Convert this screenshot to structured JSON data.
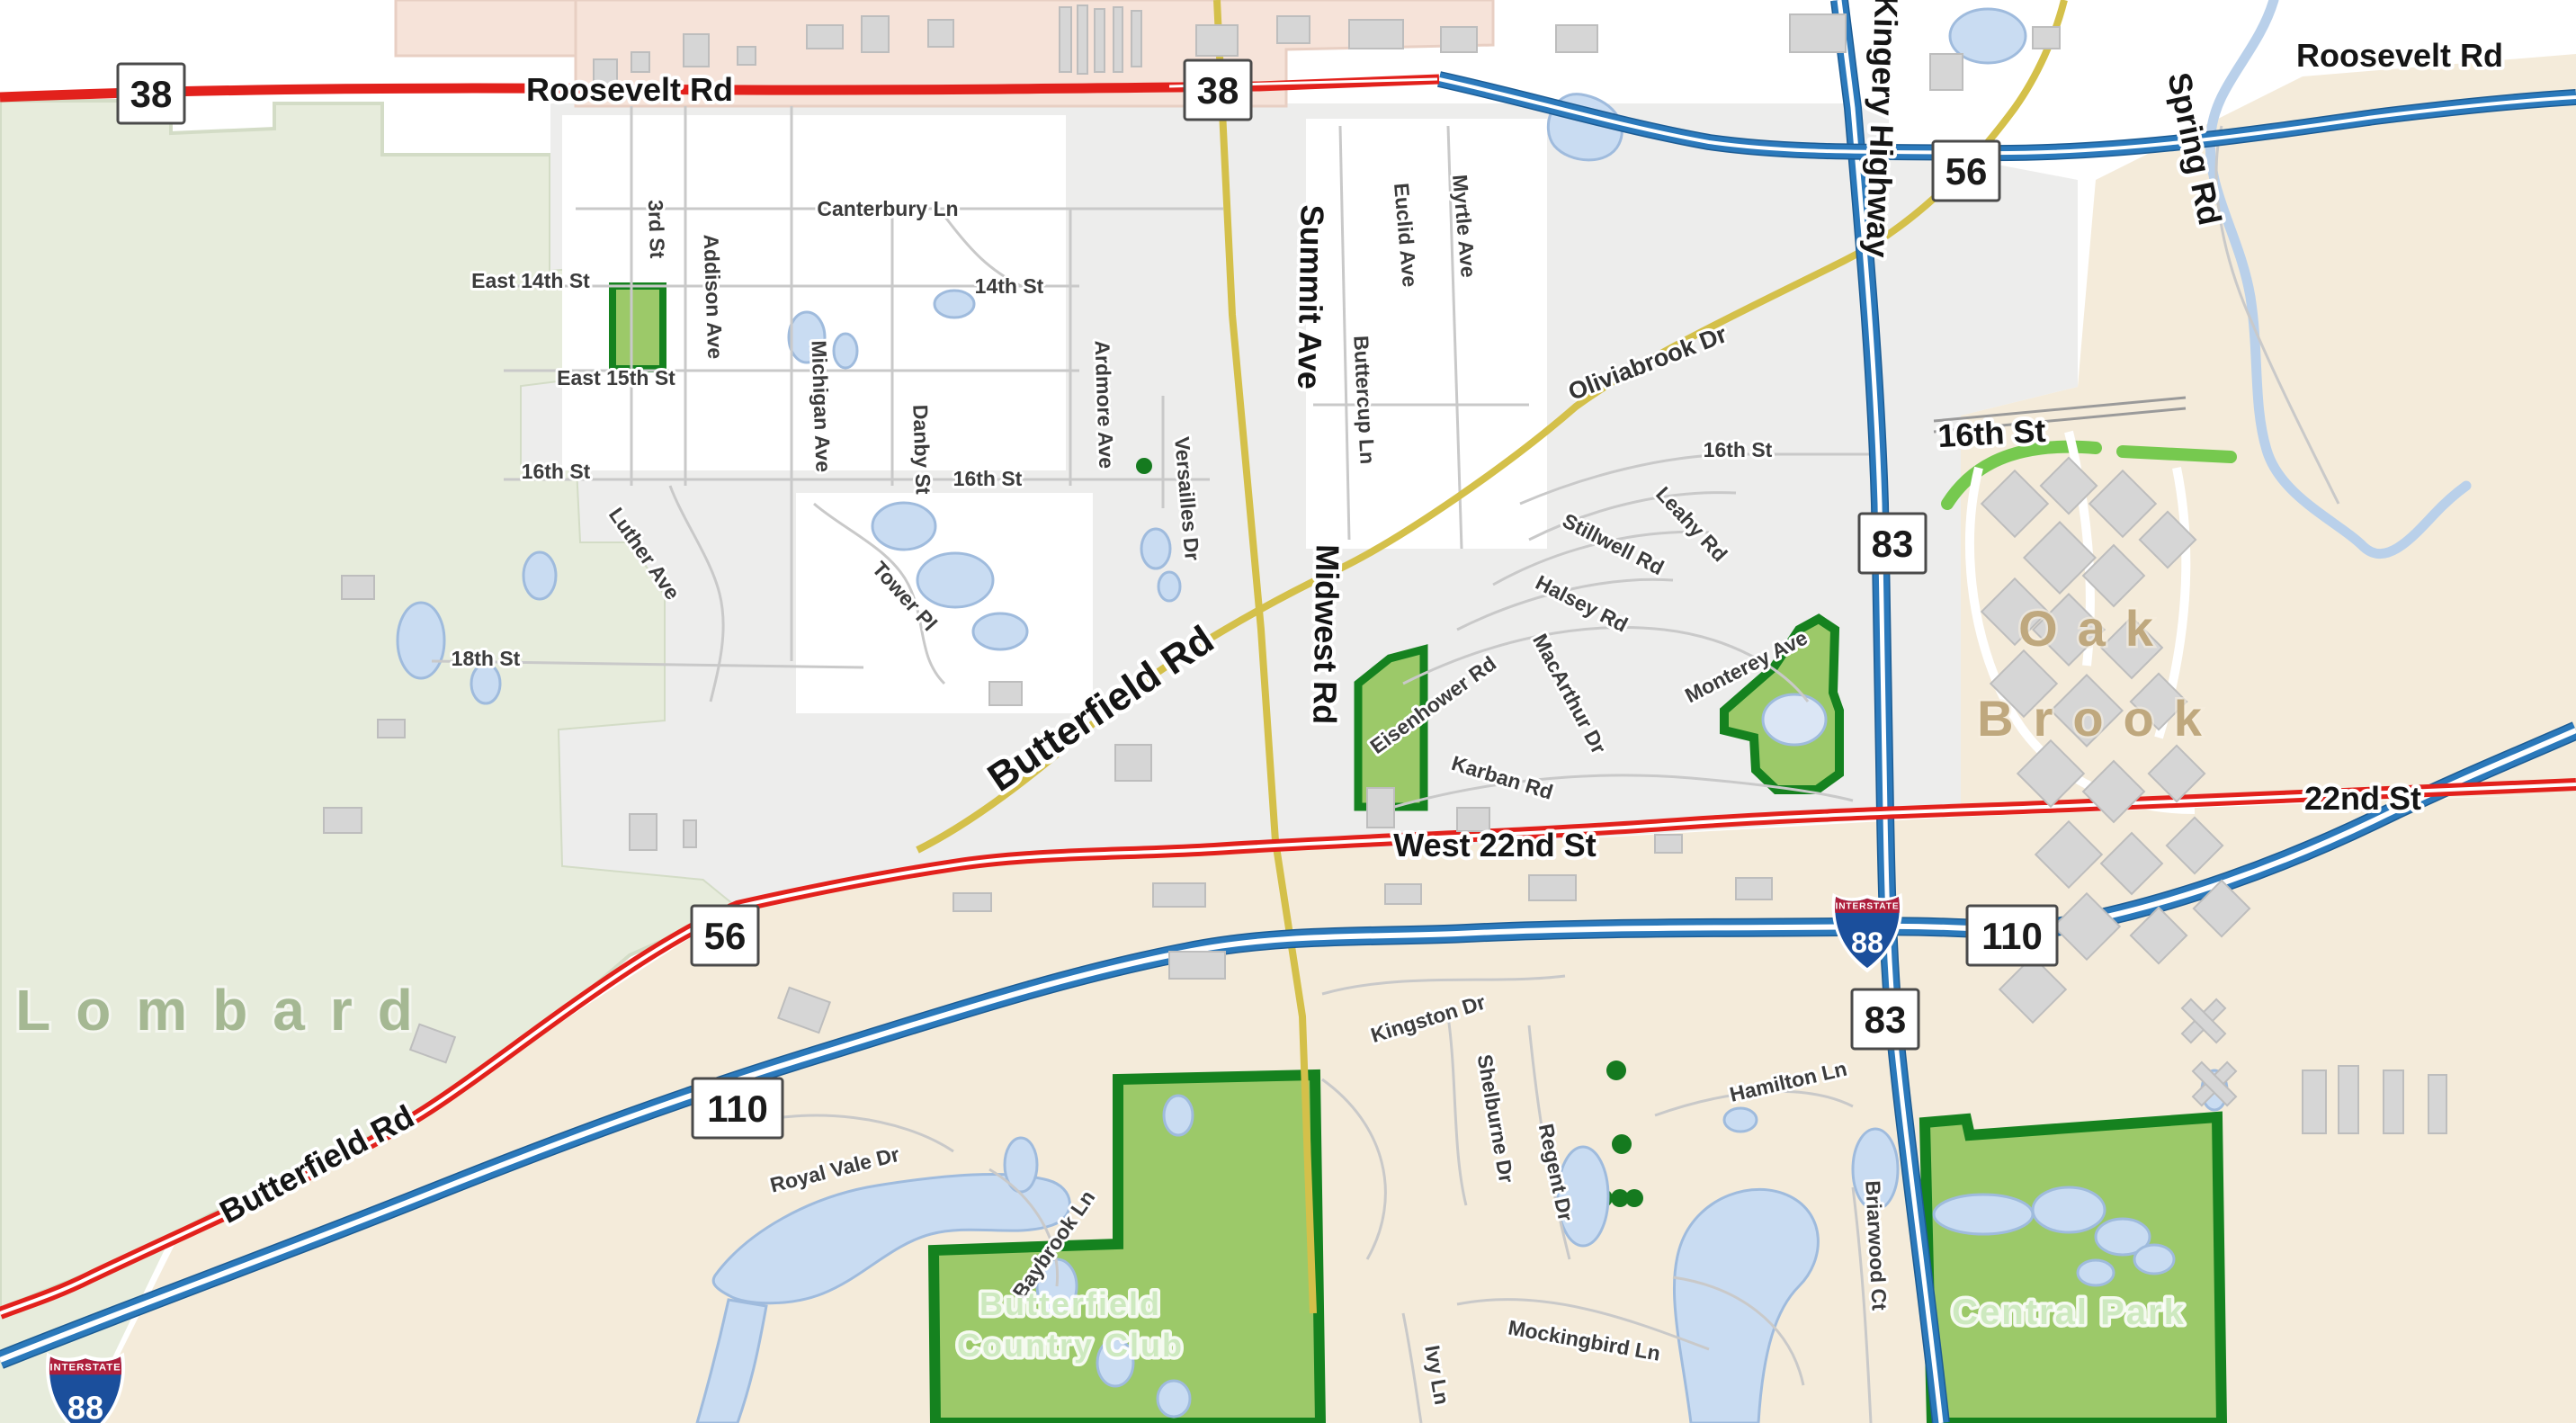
{
  "map": {
    "place_labels": {
      "lombard": "Lombard",
      "oak_brook_line1": "Oak",
      "oak_brook_line2": "Brook"
    },
    "area_labels": {
      "butterfield_cc_line1": "Butterfield",
      "butterfield_cc_line2": "Country Club",
      "central_park": "Central Park"
    },
    "major_roads": {
      "roosevelt_w": "Roosevelt Rd",
      "roosevelt_e": "Roosevelt Rd",
      "kingery": "Kingery Highway",
      "spring": "Spring Rd",
      "summit": "Summit Ave",
      "midwest": "Midwest Rd",
      "butterfield_center": "Butterfield Rd",
      "butterfield_sw": "Butterfield Rd",
      "west_22nd": "West 22nd St",
      "east_22nd": "22nd St",
      "sixteenth_bold": "16th St",
      "oliviabrook": "Oliviabrook Dr"
    },
    "streets": {
      "canterbury": "Canterbury Ln",
      "east_14th": "East 14th St",
      "third": "3rd St",
      "addison": "Addison Ave",
      "east_15th": "East 15th St",
      "fourteenth": "14th St",
      "michigan": "Michigan Ave",
      "danby": "Danby St",
      "ardmore": "Ardmore Ave",
      "sixteenth_w": "16th St",
      "sixteenth_mid": "16th St",
      "sixteenth_e": "16th St",
      "versailles": "Versailles Dr",
      "luther": "Luther Ave",
      "tower": "Tower Pl",
      "eighteenth": "18th St",
      "buttercup": "Buttercup Ln",
      "euclid": "Euclid Ave",
      "myrtle": "Myrtle Ave",
      "leahy": "Leahy Rd",
      "stillwell": "Stillwell Rd",
      "halsey": "Halsey Rd",
      "macarthur": "MacArthur Dr",
      "eisenhower": "Eisenhower Rd",
      "monterey": "Monterey Ave",
      "karban": "Karban Rd",
      "kingston": "Kingston Dr",
      "shelburne": "Shelburne Dr",
      "regent": "Regent Dr",
      "hamilton": "Hamilton Ln",
      "briarwood": "Briarwood Ct",
      "royal_vale": "Royal Vale Dr",
      "baybrook": "Baybrook Ln",
      "mockingbird": "Mockingbird Ln",
      "ivy": "Ivy Ln"
    },
    "shields": {
      "il38_a": "38",
      "il38_b": "38",
      "il56_a": "56",
      "il56_b": "56",
      "il83_a": "83",
      "il83_b": "83",
      "il110_a": "110",
      "il110_b": "110",
      "i88_a": "88",
      "i88_b": "88",
      "interstate_caption": "INTERSTATE"
    },
    "colors": {
      "road_red": "#e2211c",
      "road_blue": "#2b79bb",
      "road_yellow": "#d4c04a",
      "water": "#c9dcf2",
      "park_fill": "#9cc969",
      "park_border": "#15821f",
      "area_lombard": "#e7ecdc",
      "area_oakbrook": "#f4ebda",
      "area_residential": "#ededec",
      "area_retail": "#f6e3d9",
      "label_area_green": "#cde9bf",
      "label_oakbrook": "#bfa87e",
      "label_lombard": "#a5b893",
      "shield_interstate_blue": "#1b4f9c",
      "shield_interstate_red": "#ae1f3c"
    }
  }
}
